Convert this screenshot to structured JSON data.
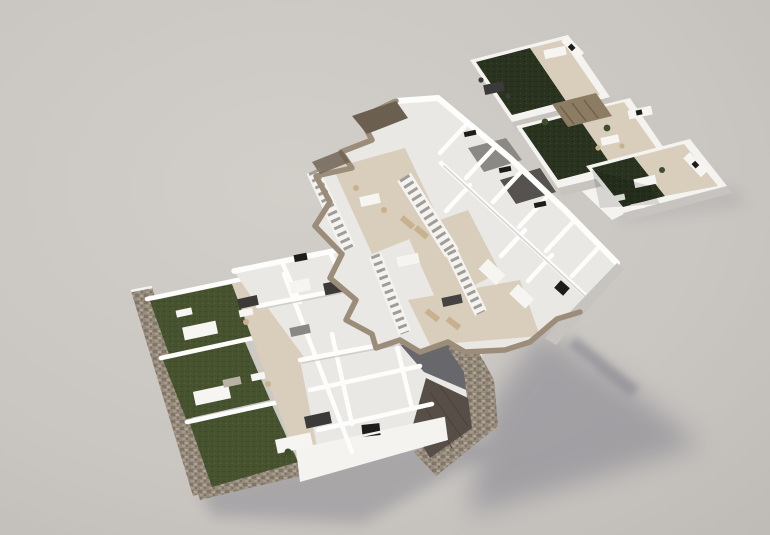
{
  "scene": {
    "kind": "3d-architectural-floorplan-render",
    "view": "aerial-axonometric",
    "clusters": [
      {
        "id": "roof-terraces",
        "position": "top-right",
        "units": 3,
        "features": [
          "dark artificial-grass patches",
          "beige tiled decks",
          "white parapet walls",
          "pergola",
          "outdoor kitchen counters",
          "dining sets",
          "loungers"
        ]
      },
      {
        "id": "first-floor",
        "position": "center",
        "units": 2,
        "features": [
          "four external staircases",
          "beige terraces with furniture",
          "white-walled bedrooms and bathrooms",
          "taupe cut-section border",
          "dark roof wedges"
        ]
      },
      {
        "id": "ground-floor",
        "position": "bottom-left",
        "units": 3,
        "features": [
          "green private gardens",
          "rubble stone perimeter wall",
          "beige patios with canopies",
          "white-walled rooms",
          "dark rear patio",
          "stone courtyard with wood deck"
        ]
      }
    ],
    "lighting": "soft daylight from upper-left, long soft shadows cast to lower-right"
  },
  "palette": {
    "bg_light": "#d2cec9",
    "bg_mid": "#c9c5c1",
    "bg_dark": "#bdb9b5",
    "shadow": "#83828c",
    "wall_white": "#f4f3f0",
    "wall_bright": "#fdfdfb",
    "wall_shade": "#c7c4c0",
    "wall_dark": "#a9a6a2",
    "floor_light": "#eae8e4",
    "floor_beige": "#d8cebb",
    "floor_tan": "#cec2ac",
    "taupe": "#9b8d7a",
    "taupe_dark": "#6b5f50",
    "stone": "#958a7b",
    "stone_dark": "#6e6557",
    "stone_light": "#b6ab9a",
    "grass_dark": "#2a331f",
    "grass_light": "#46532e",
    "patio_gray": "#68676c",
    "deck": "#574f47",
    "deck_line": "#49423b",
    "stair_tread": "#a09d99",
    "furn_dark": "#3b3a38",
    "furn_tan": "#c7b18e",
    "furn_white": "#f7f5f2",
    "window_dark": "#1d1c1b",
    "plant_green": "#3e4e2c"
  }
}
